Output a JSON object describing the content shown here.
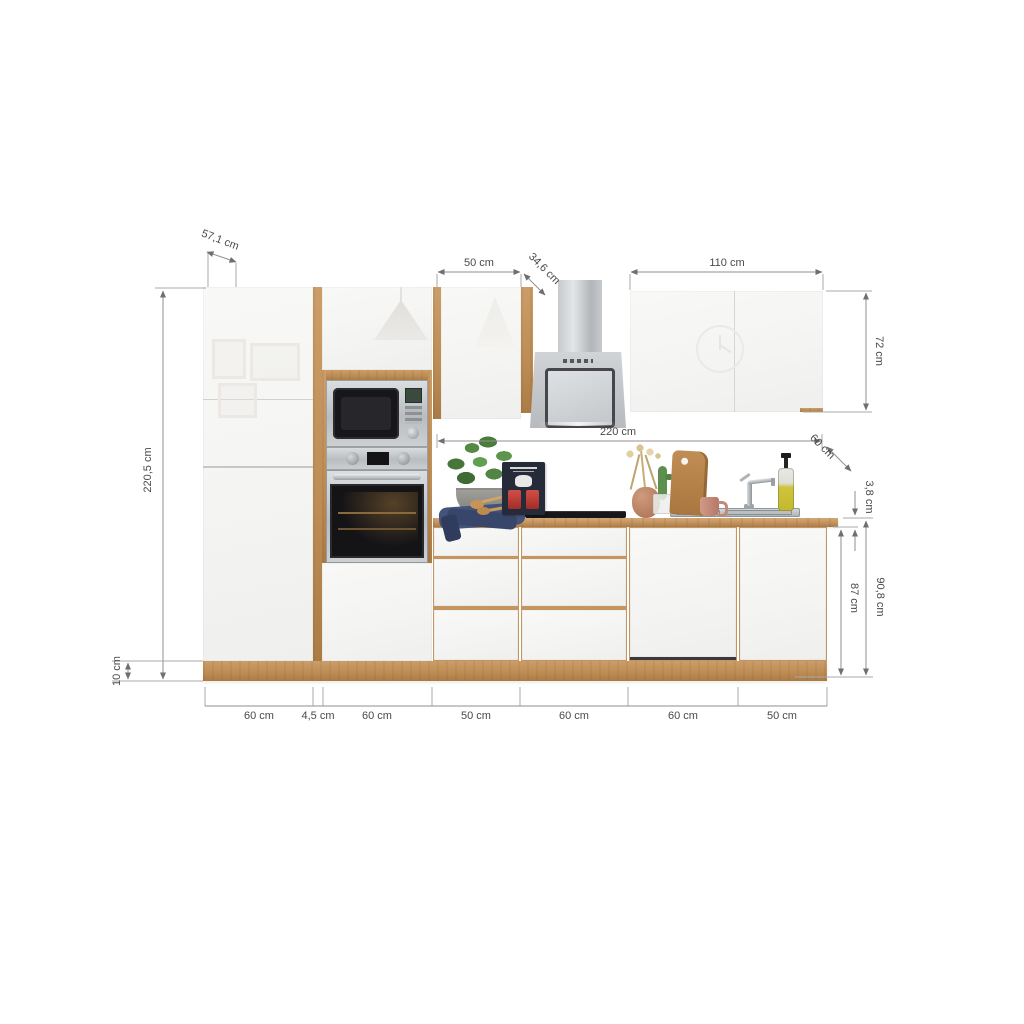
{
  "title": "Kitchen block product image with dimensions",
  "materials": {
    "wood_oak": "#bd8c55",
    "front_white": "#f5f5f3",
    "stainless": "#c3c7ca",
    "dim_line": "#8f8f8f",
    "dim_text": "#4a4a4a"
  },
  "annotations": {
    "tall_unit_depth": "57,1 cm",
    "total_height": "220,5 cm",
    "plinth_height": "10 cm",
    "wall_cabinet_left_width": "50 cm",
    "wall_cabinet_depth": "34,6 cm",
    "wall_cabinet_right_width": "110 cm",
    "wall_cabinet_height": "72 cm",
    "worktop_run_length": "220 cm",
    "worktop_depth": "60 cm",
    "worktop_thickness": "3,8 cm",
    "base_unit_height": "87 cm",
    "working_height": "90,8 cm",
    "bottom_widths": [
      "60 cm",
      "4,5 cm",
      "60 cm",
      "50 cm",
      "60 cm",
      "60 cm",
      "50 cm"
    ]
  }
}
